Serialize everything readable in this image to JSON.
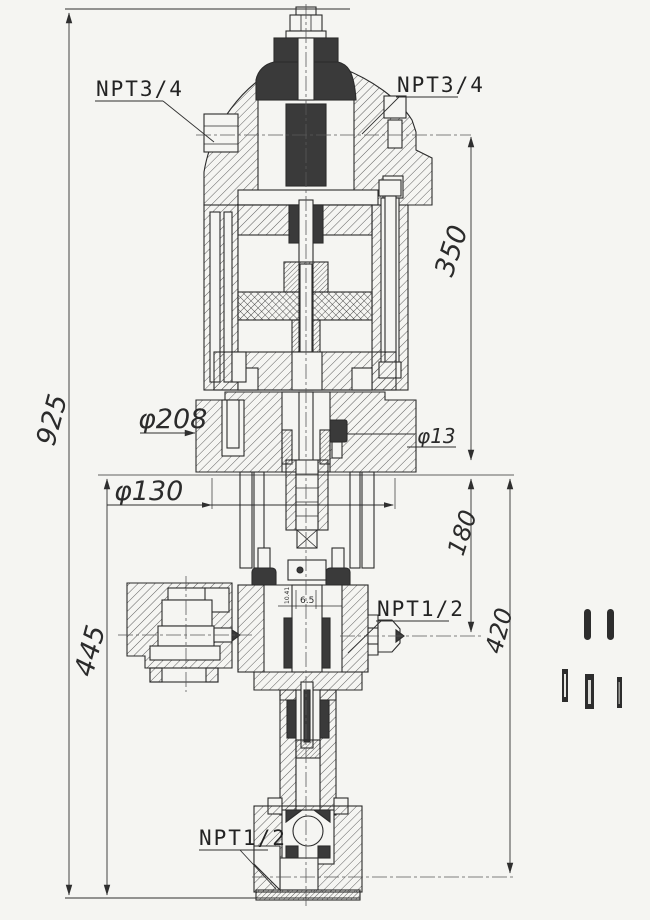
{
  "drawing": {
    "type": "engineering-section-drawing",
    "subject": "vertical plunger metering pump cross-section",
    "colors": {
      "paper": "#f5f5f2",
      "line": "#2b2b2b",
      "dark_fill": "#3a3a3a",
      "dim_line": "#333333"
    },
    "labels": {
      "npt34_left": "NPT3/4",
      "npt34_right": "NPT3/4",
      "npt12_side": "NPT1/2",
      "npt12_bottom": "NPT1/2"
    },
    "dimensions": {
      "overall_height": "925",
      "base_height": "445",
      "top_section": "350",
      "port_offset": "180",
      "lower_section": "420",
      "flange_diameter": "φ208",
      "bolt_circle": "φ130",
      "hole_diameter": "φ13",
      "seal_width": "6.5",
      "seal_detail": "10.41"
    }
  }
}
